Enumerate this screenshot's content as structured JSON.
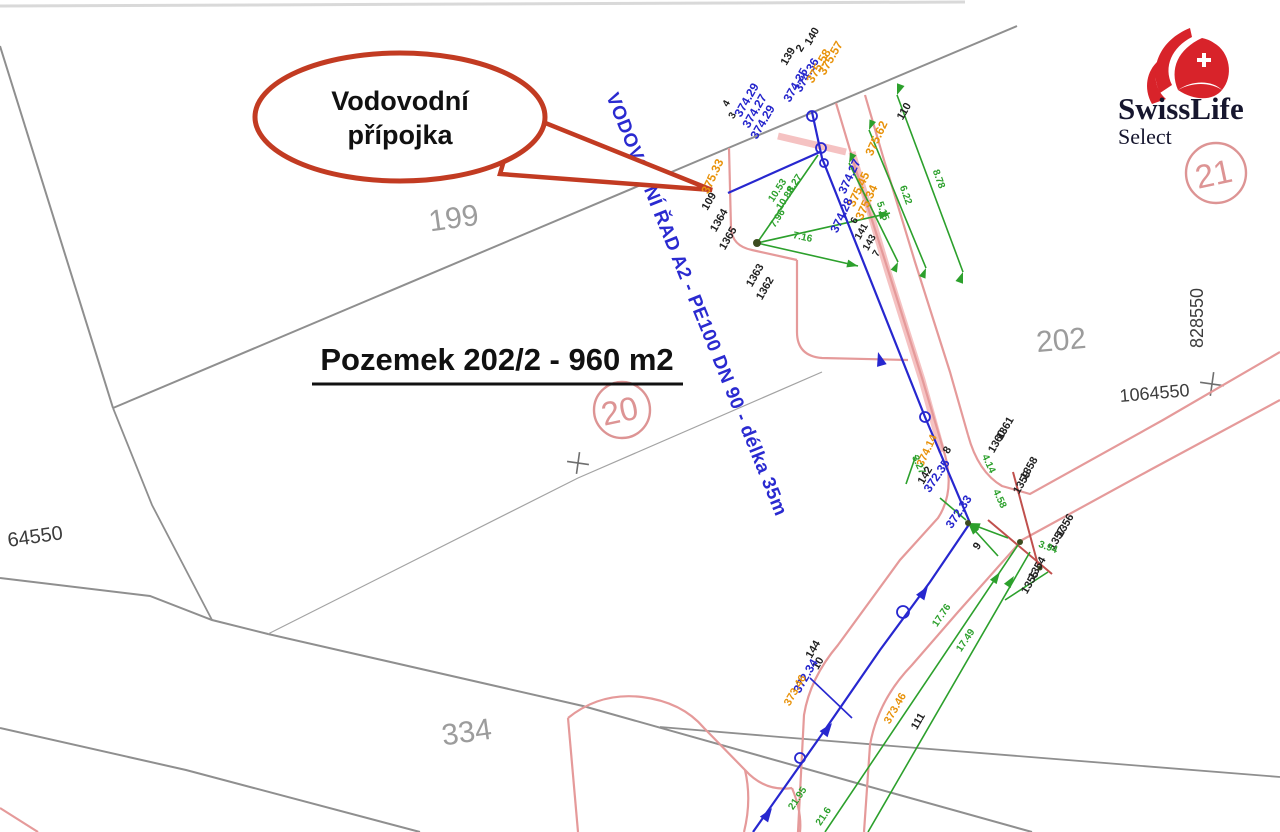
{
  "colors": {
    "k": "#1f1f1f",
    "b": "#2525cc",
    "o": "#e8920a",
    "g": "#2ca02c",
    "gy": "#9c9c9c",
    "dk": "#3c3c3c",
    "pk": "#dd9494",
    "balloon_red": "#c23b22",
    "brand_red": "#d8232a",
    "ink": "#16162e",
    "boundary_gray": "#8f8f8f",
    "road_pink": "#e59a9a",
    "crimson": "#c0504d"
  },
  "balloon": {
    "line1": "Vodovodní",
    "line2": "přípojka"
  },
  "title": {
    "text": "Pozemek 202/2 - 960 m2"
  },
  "pipe_label": {
    "text": "VODOVODNÍ ŘAD A2 - PE100 DN 90 - délka 35m"
  },
  "logo": {
    "brand": "SwissLife",
    "sub": "Select"
  },
  "labels": [
    {
      "t": "140",
      "x": 815,
      "y": 38,
      "r": -60,
      "c": "k",
      "s": 11
    },
    {
      "t": "2",
      "x": 803,
      "y": 50,
      "r": -60,
      "c": "k",
      "s": 11
    },
    {
      "t": "139",
      "x": 791,
      "y": 58,
      "r": -60,
      "c": "k",
      "s": 11
    },
    {
      "t": "374.35",
      "x": 799,
      "y": 87,
      "r": -60,
      "c": "b",
      "s": 12
    },
    {
      "t": "374.36",
      "x": 810,
      "y": 77,
      "r": -60,
      "c": "b",
      "s": 12
    },
    {
      "t": "375.58",
      "x": 822,
      "y": 68,
      "r": -60,
      "c": "o",
      "s": 12
    },
    {
      "t": "375.57",
      "x": 834,
      "y": 60,
      "r": -60,
      "c": "o",
      "s": 12
    },
    {
      "t": "4",
      "x": 729,
      "y": 105,
      "r": -60,
      "c": "k",
      "s": 10
    },
    {
      "t": "3",
      "x": 735,
      "y": 117,
      "r": -60,
      "c": "k",
      "s": 10
    },
    {
      "t": "374.29",
      "x": 750,
      "y": 102,
      "r": -60,
      "c": "b",
      "s": 12
    },
    {
      "t": "374.27",
      "x": 758,
      "y": 113,
      "r": -60,
      "c": "b",
      "s": 12
    },
    {
      "t": "374.29",
      "x": 766,
      "y": 124,
      "r": -60,
      "c": "b",
      "s": 12
    },
    {
      "t": "375.62",
      "x": 880,
      "y": 140,
      "r": -65,
      "c": "o",
      "s": 12
    },
    {
      "t": "110",
      "x": 907,
      "y": 113,
      "r": -60,
      "c": "k",
      "s": 11
    },
    {
      "t": "8.78",
      "x": 936,
      "y": 180,
      "r": 70,
      "c": "g",
      "s": 10
    },
    {
      "t": "6.22",
      "x": 903,
      "y": 196,
      "r": 70,
      "c": "g",
      "s": 10
    },
    {
      "t": "5.15",
      "x": 880,
      "y": 212,
      "r": 70,
      "c": "g",
      "s": 10
    },
    {
      "t": "375.33",
      "x": 716,
      "y": 178,
      "r": -65,
      "c": "o",
      "s": 12
    },
    {
      "t": "109",
      "x": 712,
      "y": 203,
      "r": -60,
      "c": "k",
      "s": 11
    },
    {
      "t": "1364",
      "x": 722,
      "y": 222,
      "r": -60,
      "c": "k",
      "s": 11
    },
    {
      "t": "1365",
      "x": 731,
      "y": 240,
      "r": -60,
      "c": "k",
      "s": 11
    },
    {
      "t": "10.53",
      "x": 780,
      "y": 192,
      "r": -57,
      "c": "g",
      "s": 10
    },
    {
      "t": "10.88",
      "x": 788,
      "y": 200,
      "r": -57,
      "c": "g",
      "s": 10
    },
    {
      "t": "8.27",
      "x": 797,
      "y": 185,
      "r": -57,
      "c": "g",
      "s": 10
    },
    {
      "t": "7.96",
      "x": 780,
      "y": 220,
      "r": -57,
      "c": "g",
      "s": 10
    },
    {
      "t": "7.16",
      "x": 802,
      "y": 240,
      "r": 12,
      "c": "g",
      "s": 10
    },
    {
      "t": "374.27",
      "x": 853,
      "y": 178,
      "r": -65,
      "c": "b",
      "s": 12
    },
    {
      "t": "375.45",
      "x": 862,
      "y": 191,
      "r": -65,
      "c": "o",
      "s": 12
    },
    {
      "t": "375.34",
      "x": 870,
      "y": 204,
      "r": -65,
      "c": "o",
      "s": 12
    },
    {
      "t": "374.28",
      "x": 845,
      "y": 217,
      "r": -65,
      "c": "b",
      "s": 12
    },
    {
      "t": "6",
      "x": 857,
      "y": 222,
      "r": -60,
      "c": "k",
      "s": 10
    },
    {
      "t": "141",
      "x": 864,
      "y": 233,
      "r": -60,
      "c": "k",
      "s": 10
    },
    {
      "t": "143",
      "x": 872,
      "y": 244,
      "r": -60,
      "c": "k",
      "s": 10
    },
    {
      "t": "7",
      "x": 879,
      "y": 255,
      "r": -60,
      "c": "k",
      "s": 10
    },
    {
      "t": "1363",
      "x": 758,
      "y": 277,
      "r": -60,
      "c": "k",
      "s": 11
    },
    {
      "t": "1362",
      "x": 768,
      "y": 290,
      "r": -60,
      "c": "k",
      "s": 11
    },
    {
      "t": "374.14",
      "x": 930,
      "y": 452,
      "r": -65,
      "c": "o",
      "s": 11
    },
    {
      "t": "3.27",
      "x": 916,
      "y": 466,
      "r": 65,
      "c": "g",
      "s": 10
    },
    {
      "t": "142",
      "x": 928,
      "y": 477,
      "r": -60,
      "c": "k",
      "s": 11
    },
    {
      "t": "4.14",
      "x": 986,
      "y": 465,
      "r": 65,
      "c": "g",
      "s": 10
    },
    {
      "t": "4.58",
      "x": 997,
      "y": 500,
      "r": 65,
      "c": "g",
      "s": 10
    },
    {
      "t": "8",
      "x": 950,
      "y": 452,
      "r": -56,
      "c": "k",
      "s": 11
    },
    {
      "t": "372.35",
      "x": 940,
      "y": 478,
      "r": -56,
      "c": "b",
      "s": 12
    },
    {
      "t": "372.33",
      "x": 962,
      "y": 514,
      "r": -56,
      "c": "b",
      "s": 12
    },
    {
      "t": "9",
      "x": 980,
      "y": 548,
      "r": -56,
      "c": "k",
      "s": 11
    },
    {
      "t": "1361",
      "x": 1008,
      "y": 430,
      "r": -60,
      "c": "k",
      "s": 11
    },
    {
      "t": "1360",
      "x": 1000,
      "y": 443,
      "r": -60,
      "c": "k",
      "s": 11
    },
    {
      "t": "1358",
      "x": 1032,
      "y": 470,
      "r": -60,
      "c": "k",
      "s": 11
    },
    {
      "t": "1359",
      "x": 1025,
      "y": 484,
      "r": -60,
      "c": "k",
      "s": 11
    },
    {
      "t": "1356",
      "x": 1068,
      "y": 527,
      "r": -60,
      "c": "k",
      "s": 11
    },
    {
      "t": "1357",
      "x": 1060,
      "y": 540,
      "r": -60,
      "c": "k",
      "s": 11
    },
    {
      "t": "3.94",
      "x": 1047,
      "y": 550,
      "r": 20,
      "c": "g",
      "s": 10
    },
    {
      "t": "1354",
      "x": 1040,
      "y": 570,
      "r": -60,
      "c": "k",
      "s": 11
    },
    {
      "t": "1355",
      "x": 1033,
      "y": 584,
      "r": -60,
      "c": "k",
      "s": 11
    },
    {
      "t": "17.76",
      "x": 944,
      "y": 617,
      "r": -56,
      "c": "g",
      "s": 10
    },
    {
      "t": "17.49",
      "x": 968,
      "y": 642,
      "r": -56,
      "c": "g",
      "s": 10
    },
    {
      "t": "144",
      "x": 816,
      "y": 651,
      "r": -60,
      "c": "k",
      "s": 11
    },
    {
      "t": "10",
      "x": 821,
      "y": 665,
      "r": -60,
      "c": "k",
      "s": 11
    },
    {
      "t": "372.34",
      "x": 809,
      "y": 678,
      "r": -60,
      "c": "b",
      "s": 12
    },
    {
      "t": "373.46",
      "x": 798,
      "y": 692,
      "r": -60,
      "c": "o",
      "s": 11
    },
    {
      "t": "373.46",
      "x": 898,
      "y": 710,
      "r": -60,
      "c": "o",
      "s": 11
    },
    {
      "t": "111",
      "x": 921,
      "y": 723,
      "r": -60,
      "c": "k",
      "s": 11
    },
    {
      "t": "21.95",
      "x": 800,
      "y": 800,
      "r": -56,
      "c": "g",
      "s": 10
    },
    {
      "t": "21.6",
      "x": 826,
      "y": 818,
      "r": -56,
      "c": "g",
      "s": 10
    },
    {
      "t": "199",
      "x": 455,
      "y": 228,
      "r": -8,
      "c": "gy",
      "s": 30
    },
    {
      "t": "202",
      "x": 1062,
      "y": 350,
      "r": -5,
      "c": "gy",
      "s": 30
    },
    {
      "t": "334",
      "x": 468,
      "y": 742,
      "r": -8,
      "c": "gy",
      "s": 30
    },
    {
      "t": "20",
      "x": 622,
      "y": 422,
      "r": -12,
      "c": "pk",
      "s": 33
    },
    {
      "t": "21",
      "x": 1216,
      "y": 185,
      "r": -12,
      "c": "pk",
      "s": 33
    },
    {
      "t": "64550",
      "x": 36,
      "y": 543,
      "r": -8,
      "c": "dk",
      "s": 20
    },
    {
      "t": "828550",
      "x": 1203,
      "y": 318,
      "r": -90,
      "c": "dk",
      "s": 18
    },
    {
      "t": "1064550",
      "x": 1155,
      "y": 399,
      "r": -5,
      "c": "dk",
      "s": 18
    }
  ]
}
